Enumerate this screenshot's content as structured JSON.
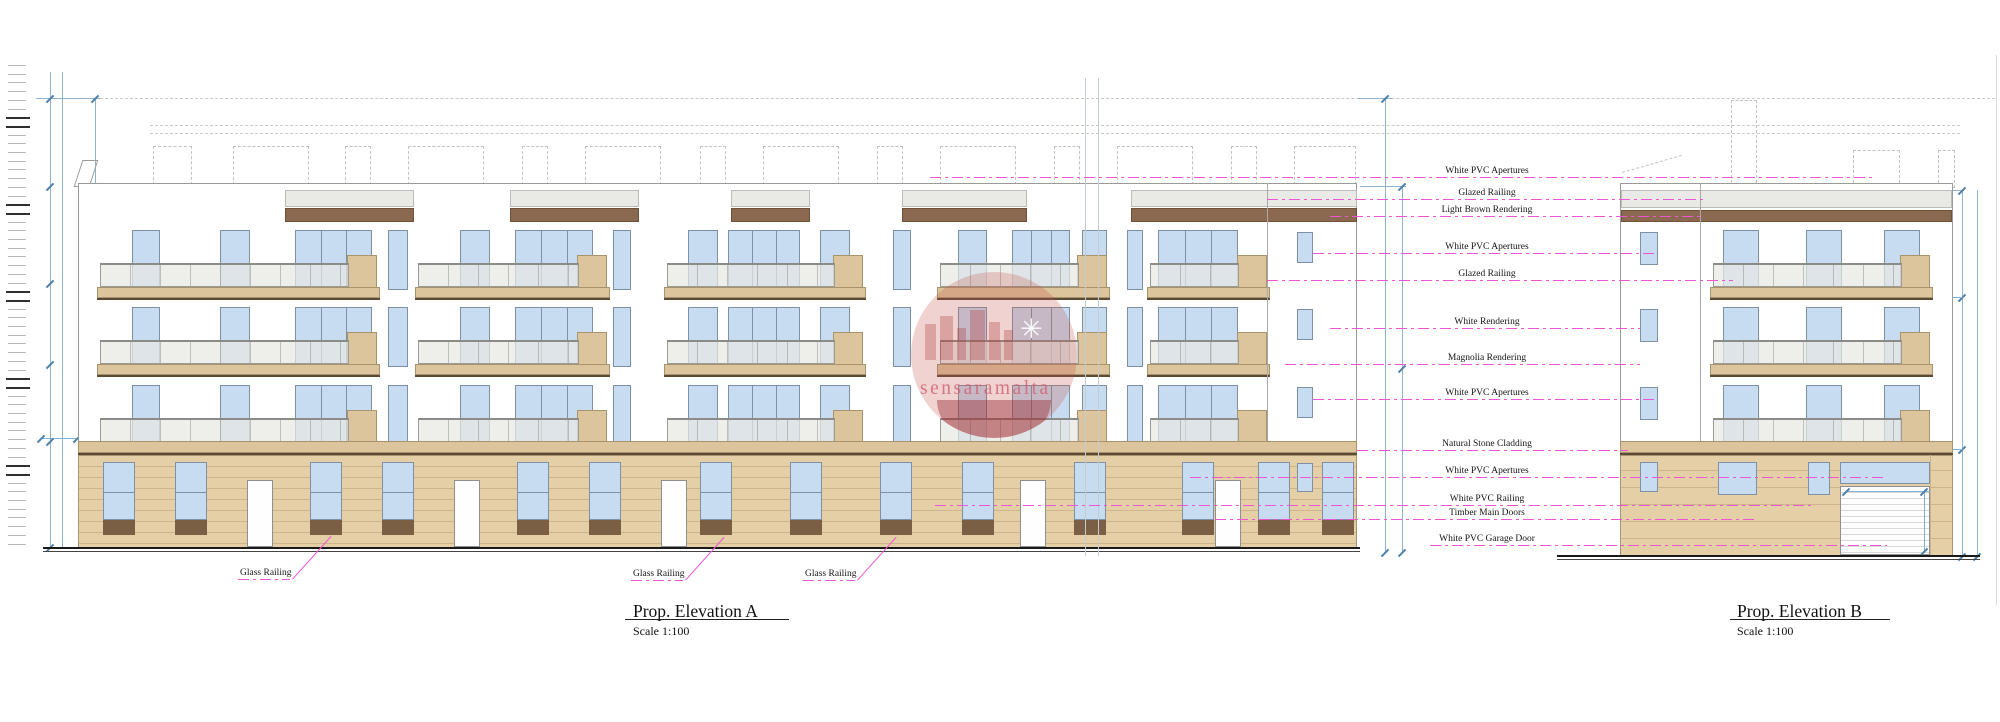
{
  "elevation_a": {
    "title": "Prop. Elevation A",
    "scale_label": "Scale 1:100"
  },
  "elevation_b": {
    "title": "Prop. Elevation B",
    "scale_label": "Scale 1:100"
  },
  "watermark": {
    "text": "sensaramalta"
  },
  "annotations": [
    {
      "label": "White PVC Apertures",
      "y": 177,
      "x1": 930,
      "x2": 1873
    },
    {
      "label": "Glazed Railing",
      "y": 199,
      "x1": 1267,
      "x2": 1703
    },
    {
      "label": "Light Brown Rendering",
      "y": 216,
      "x1": 1330,
      "x2": 1700
    },
    {
      "label": "White PVC Apertures",
      "y": 253,
      "x1": 1313,
      "x2": 1658
    },
    {
      "label": "Glazed Railing",
      "y": 280,
      "x1": 1267,
      "x2": 1733
    },
    {
      "label": "White Rendering",
      "y": 328,
      "x1": 1330,
      "x2": 1640
    },
    {
      "label": "Magnolia Rendering",
      "y": 364,
      "x1": 1285,
      "x2": 1640
    },
    {
      "label": "White PVC Apertures",
      "y": 399,
      "x1": 1313,
      "x2": 1658
    },
    {
      "label": "Natural Stone Cladding",
      "y": 450,
      "x1": 1357,
      "x2": 1628
    },
    {
      "label": "White PVC Apertures",
      "y": 477,
      "x1": 1190,
      "x2": 1887
    },
    {
      "label": "White PVC Railing",
      "y": 505,
      "x1": 935,
      "x2": 1813
    },
    {
      "label": "Timber Main Doors",
      "y": 519,
      "x1": 1215,
      "x2": 1756
    },
    {
      "label": "White PVC Garage Door",
      "y": 545,
      "x1": 1430,
      "x2": 1887
    }
  ],
  "ground_labels": [
    {
      "label": "Glass Railing",
      "x": 240,
      "y": 568
    },
    {
      "label": "Glass Railing",
      "x": 633,
      "y": 569
    },
    {
      "label": "Glass Railing",
      "x": 805,
      "y": 569
    }
  ],
  "colors": {
    "window_blue": "#c7dcf0",
    "window_frame": "#7e91a4",
    "balcony_slab": "#dcc49c",
    "stone_cladding": "#e4cfa6",
    "stone_joint": "#cdb48a",
    "light_brown_render": "#8a6950",
    "timber_base_brown": "#7b5f44",
    "leader_pink": "#ee55d6",
    "dimension_blue": "#8fb3cf"
  }
}
